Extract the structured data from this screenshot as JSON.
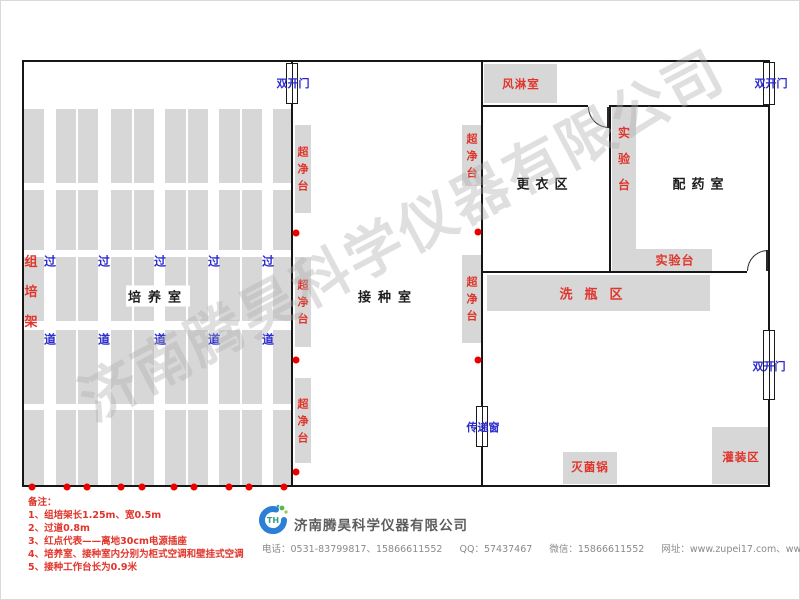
{
  "colors": {
    "wall": "#161616",
    "equipment_fill": "#d7d7d7",
    "red_label": "#e0352b",
    "blue_label": "#2b2bd0",
    "power_dot": "#ea0000",
    "watermark_grey": "#aeaeae"
  },
  "watermark": {
    "text": "济南腾昊科学仪器有限公司"
  },
  "rooms": {
    "culture": "培养室",
    "inoculation": "接种室",
    "changing": "更衣区",
    "dispensing": "配药室",
    "air_shower": "风淋室",
    "bottle_washing": "洗瓶区",
    "sterilizer": "灭菌锅",
    "filling": "灌装区"
  },
  "labels": {
    "rack": "组培架",
    "clean_bench": "超净台",
    "lab_bench": "实验台",
    "double_door": "双开门",
    "transfer_window": "传递窗",
    "aisle_char_top": "过",
    "aisle_char_bottom": "道"
  },
  "notes": {
    "title": "备注：",
    "items": [
      "1、组培架长1.25m、宽0.5m",
      "2、过道0.8m",
      "3、红点代表——离地30cm电源插座",
      "4、培养室、接种室内分别为柜式空调和壁挂式空调",
      "5、接种工作台长为0.9米"
    ]
  },
  "footer": {
    "company": "济南腾昊科学仪器有限公司",
    "logo_text": "TH",
    "contact": [
      "电话：0531-83799817、15866611552",
      "QQ：57437467",
      "微信：15866611552",
      "网址：www.zupei17.com、www.cnhtkj.com"
    ]
  },
  "floorplan": {
    "rack_bands": [
      {
        "x": 24,
        "w": 20,
        "double": false
      },
      {
        "x": 56,
        "w": 42,
        "double": true
      },
      {
        "x": 111,
        "w": 43,
        "double": true
      },
      {
        "x": 165,
        "w": 43,
        "double": true
      },
      {
        "x": 219,
        "w": 43,
        "double": true
      },
      {
        "x": 273,
        "w": 18,
        "double": false
      }
    ],
    "rack_rows": [
      {
        "y": 109,
        "h": 74
      },
      {
        "y": 190,
        "h": 60
      },
      {
        "y": 257,
        "h": 64
      },
      {
        "y": 330,
        "h": 74
      },
      {
        "y": 410,
        "h": 75
      }
    ],
    "aisle_xs": [
      50,
      104,
      160,
      214,
      268
    ],
    "aisle_top_y": 261,
    "aisle_bottom_y": 339,
    "clean_benches": [
      {
        "x": 295,
        "y": 125,
        "w": 16,
        "h": 88
      },
      {
        "x": 295,
        "y": 257,
        "w": 16,
        "h": 90
      },
      {
        "x": 295,
        "y": 378,
        "w": 16,
        "h": 85
      },
      {
        "x": 462,
        "y": 125,
        "w": 20,
        "h": 61
      },
      {
        "x": 462,
        "y": 255,
        "w": 20,
        "h": 88
      }
    ],
    "power_dots": [
      [
        32,
        487
      ],
      [
        67,
        487
      ],
      [
        87,
        487
      ],
      [
        121,
        487
      ],
      [
        142,
        487
      ],
      [
        174,
        487
      ],
      [
        194,
        487
      ],
      [
        229,
        487
      ],
      [
        249,
        487
      ],
      [
        284,
        487
      ],
      [
        296,
        233
      ],
      [
        296,
        360
      ],
      [
        296,
        472
      ],
      [
        478,
        232
      ],
      [
        478,
        360
      ]
    ],
    "doors": [
      {
        "x": 286,
        "y": 63,
        "w": 12,
        "h": 41,
        "label": "double_door",
        "lx": 293,
        "ly": 83
      },
      {
        "x": 763,
        "y": 62,
        "w": 12,
        "h": 43,
        "label": "double_door",
        "lx": 771,
        "ly": 83
      },
      {
        "x": 763,
        "y": 330,
        "w": 12,
        "h": 70,
        "label": "double_door",
        "lx": 769,
        "ly": 366
      },
      {
        "x": 476,
        "y": 406,
        "w": 12,
        "h": 41,
        "label": "transfer_window",
        "lx": 483,
        "ly": 427
      }
    ]
  }
}
